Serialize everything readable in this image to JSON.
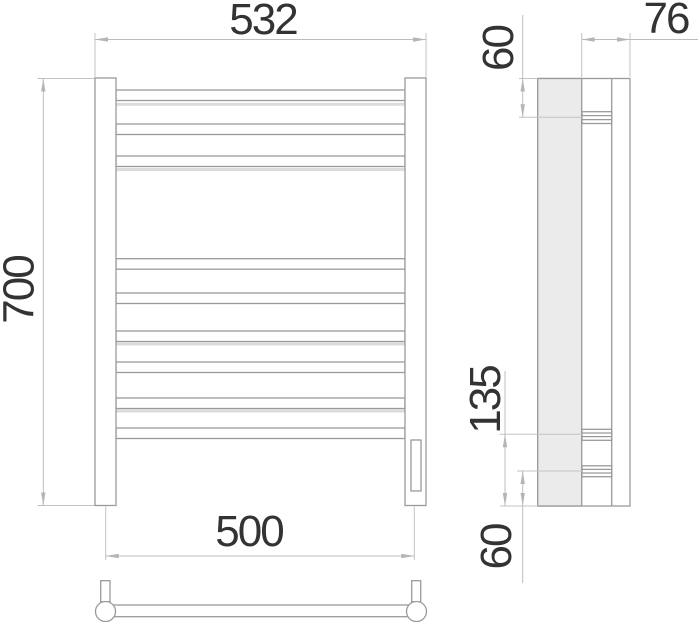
{
  "drawing": {
    "description": "Towel rail technical drawing, three views",
    "dimensions": {
      "overall_width": "532",
      "overall_height": "700",
      "connection_spacing": "500",
      "side_top_offset": "60",
      "wall_depth": "76",
      "side_lower_section": "135",
      "side_bottom_offset": "60"
    },
    "colors": {
      "object_line": "#9a9a9a",
      "dimension_line": "#bcbcbc",
      "label_text": "#333333",
      "profile_fill": "#ebebeb",
      "reflection": "#dcdcdc"
    }
  }
}
